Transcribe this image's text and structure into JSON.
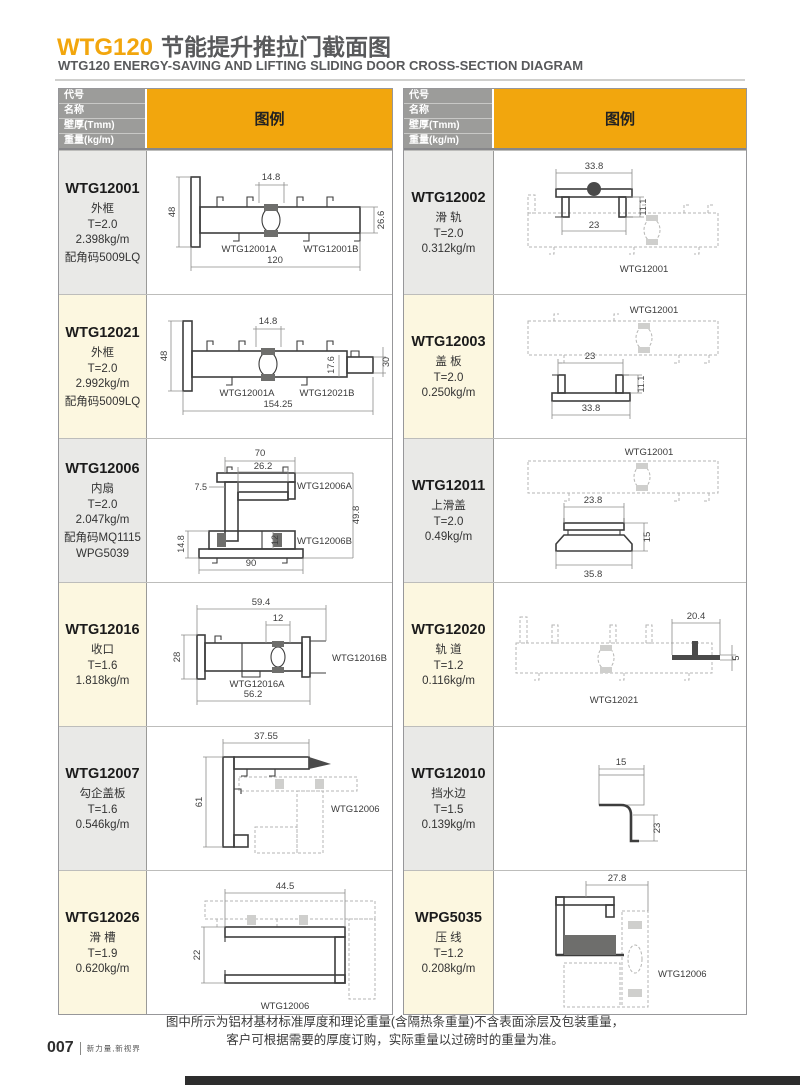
{
  "page": {
    "title_code": "WTG120",
    "title_zh": "节能提升推拉门截面图",
    "subtitle": "WTG120 ENERGY-SAVING AND LIFTING SLIDING DOOR CROSS-SECTION DIAGRAM",
    "note_line1": "图中所示为铝材基材标准厚度和理论重量(含隔热条重量)不含表面涂层及包装重量，",
    "note_line2": "客户可根据需要的厚度订购，实际重量以过磅时的重量为准。",
    "page_number": "007",
    "brand": "新力量,新视界"
  },
  "header": {
    "labels": [
      "代号",
      "名称",
      "壁厚(Tmm)",
      "重量(kg/m)"
    ],
    "legend": "图例"
  },
  "colors": {
    "accent": "#F2A60D",
    "header_gray": "#9C9C9A",
    "row_gray": "#E9E9E7",
    "row_cream": "#FCF7E0"
  },
  "left": {
    "rows": [
      {
        "code": "WTG12001",
        "name": "外框",
        "thickness": "T=2.0",
        "weight": "2.398kg/m",
        "extra1": "配角码5009LQ",
        "dims": {
          "top": "14.8",
          "height": "48",
          "right": "26.6",
          "width": "120"
        },
        "labels": {
          "a": "WTG12001A",
          "b": "WTG12001B"
        }
      },
      {
        "code": "WTG12021",
        "name": "外框",
        "thickness": "T=2.0",
        "weight": "2.992kg/m",
        "extra1": "配角码5009LQ",
        "dims": {
          "top": "14.8",
          "height": "48",
          "step_h": "17.6",
          "step_w": "30",
          "width": "154.25"
        },
        "labels": {
          "a": "WTG12001A",
          "b": "WTG12021B"
        }
      },
      {
        "code": "WTG12006",
        "name": "内扇",
        "thickness": "T=2.0",
        "weight": "2.047kg/m",
        "extra1": "配角码MQ1115",
        "extra2": "WPG5039",
        "dims": {
          "top": "70",
          "top2": "26.2",
          "left": "7.5",
          "left2": "14.8",
          "inner": "12",
          "right": "49.8",
          "width": "90"
        },
        "labels": {
          "a": "WTG12006A",
          "b": "WTG12006B"
        }
      },
      {
        "code": "WTG12016",
        "name": "收口",
        "thickness": "T=1.6",
        "weight": "1.818kg/m",
        "dims": {
          "top": "59.4",
          "top2": "12",
          "left": "28",
          "width": "56.2"
        },
        "labels": {
          "a": "WTG12016A",
          "b": "WTG12016B"
        }
      },
      {
        "code": "WTG12007",
        "name": "勾企盖板",
        "thickness": "T=1.6",
        "weight": "0.546kg/m",
        "dims": {
          "top": "37.55",
          "left": "61"
        },
        "ref": "WTG12006"
      },
      {
        "code": "WTG12026",
        "name": "滑 槽",
        "thickness": "T=1.9",
        "weight": "0.620kg/m",
        "dims": {
          "top": "44.5",
          "left": "22"
        },
        "ref": "WTG12006"
      }
    ]
  },
  "right": {
    "rows": [
      {
        "code": "WTG12002",
        "name": "滑 轨",
        "thickness": "T=2.0",
        "weight": "0.312kg/m",
        "dims": {
          "top": "33.8",
          "right": "11.1",
          "inner": "23"
        },
        "ref": "WTG12001"
      },
      {
        "code": "WTG12003",
        "name": "盖 板",
        "thickness": "T=2.0",
        "weight": "0.250kg/m",
        "dims": {
          "top": "23",
          "right": "11.1",
          "bottom": "33.8"
        },
        "ref": "WTG12001"
      },
      {
        "code": "WTG12011",
        "name": "上滑盖",
        "thickness": "T=2.0",
        "weight": "0.49kg/m",
        "dims": {
          "top": "23.8",
          "right": "15",
          "bottom": "35.8"
        },
        "ref": "WTG12001"
      },
      {
        "code": "WTG12020",
        "name": "轨 道",
        "thickness": "T=1.2",
        "weight": "0.116kg/m",
        "dims": {
          "top": "20.4",
          "right": "5"
        },
        "ref": "WTG12021"
      },
      {
        "code": "WTG12010",
        "name": "挡水边",
        "thickness": "T=1.5",
        "weight": "0.139kg/m",
        "dims": {
          "top": "15",
          "right": "23"
        }
      },
      {
        "code": "WPG5035",
        "name": "压 线",
        "thickness": "T=1.2",
        "weight": "0.208kg/m",
        "dims": {
          "top": "27.8"
        },
        "ref": "WTG12006"
      }
    ]
  }
}
